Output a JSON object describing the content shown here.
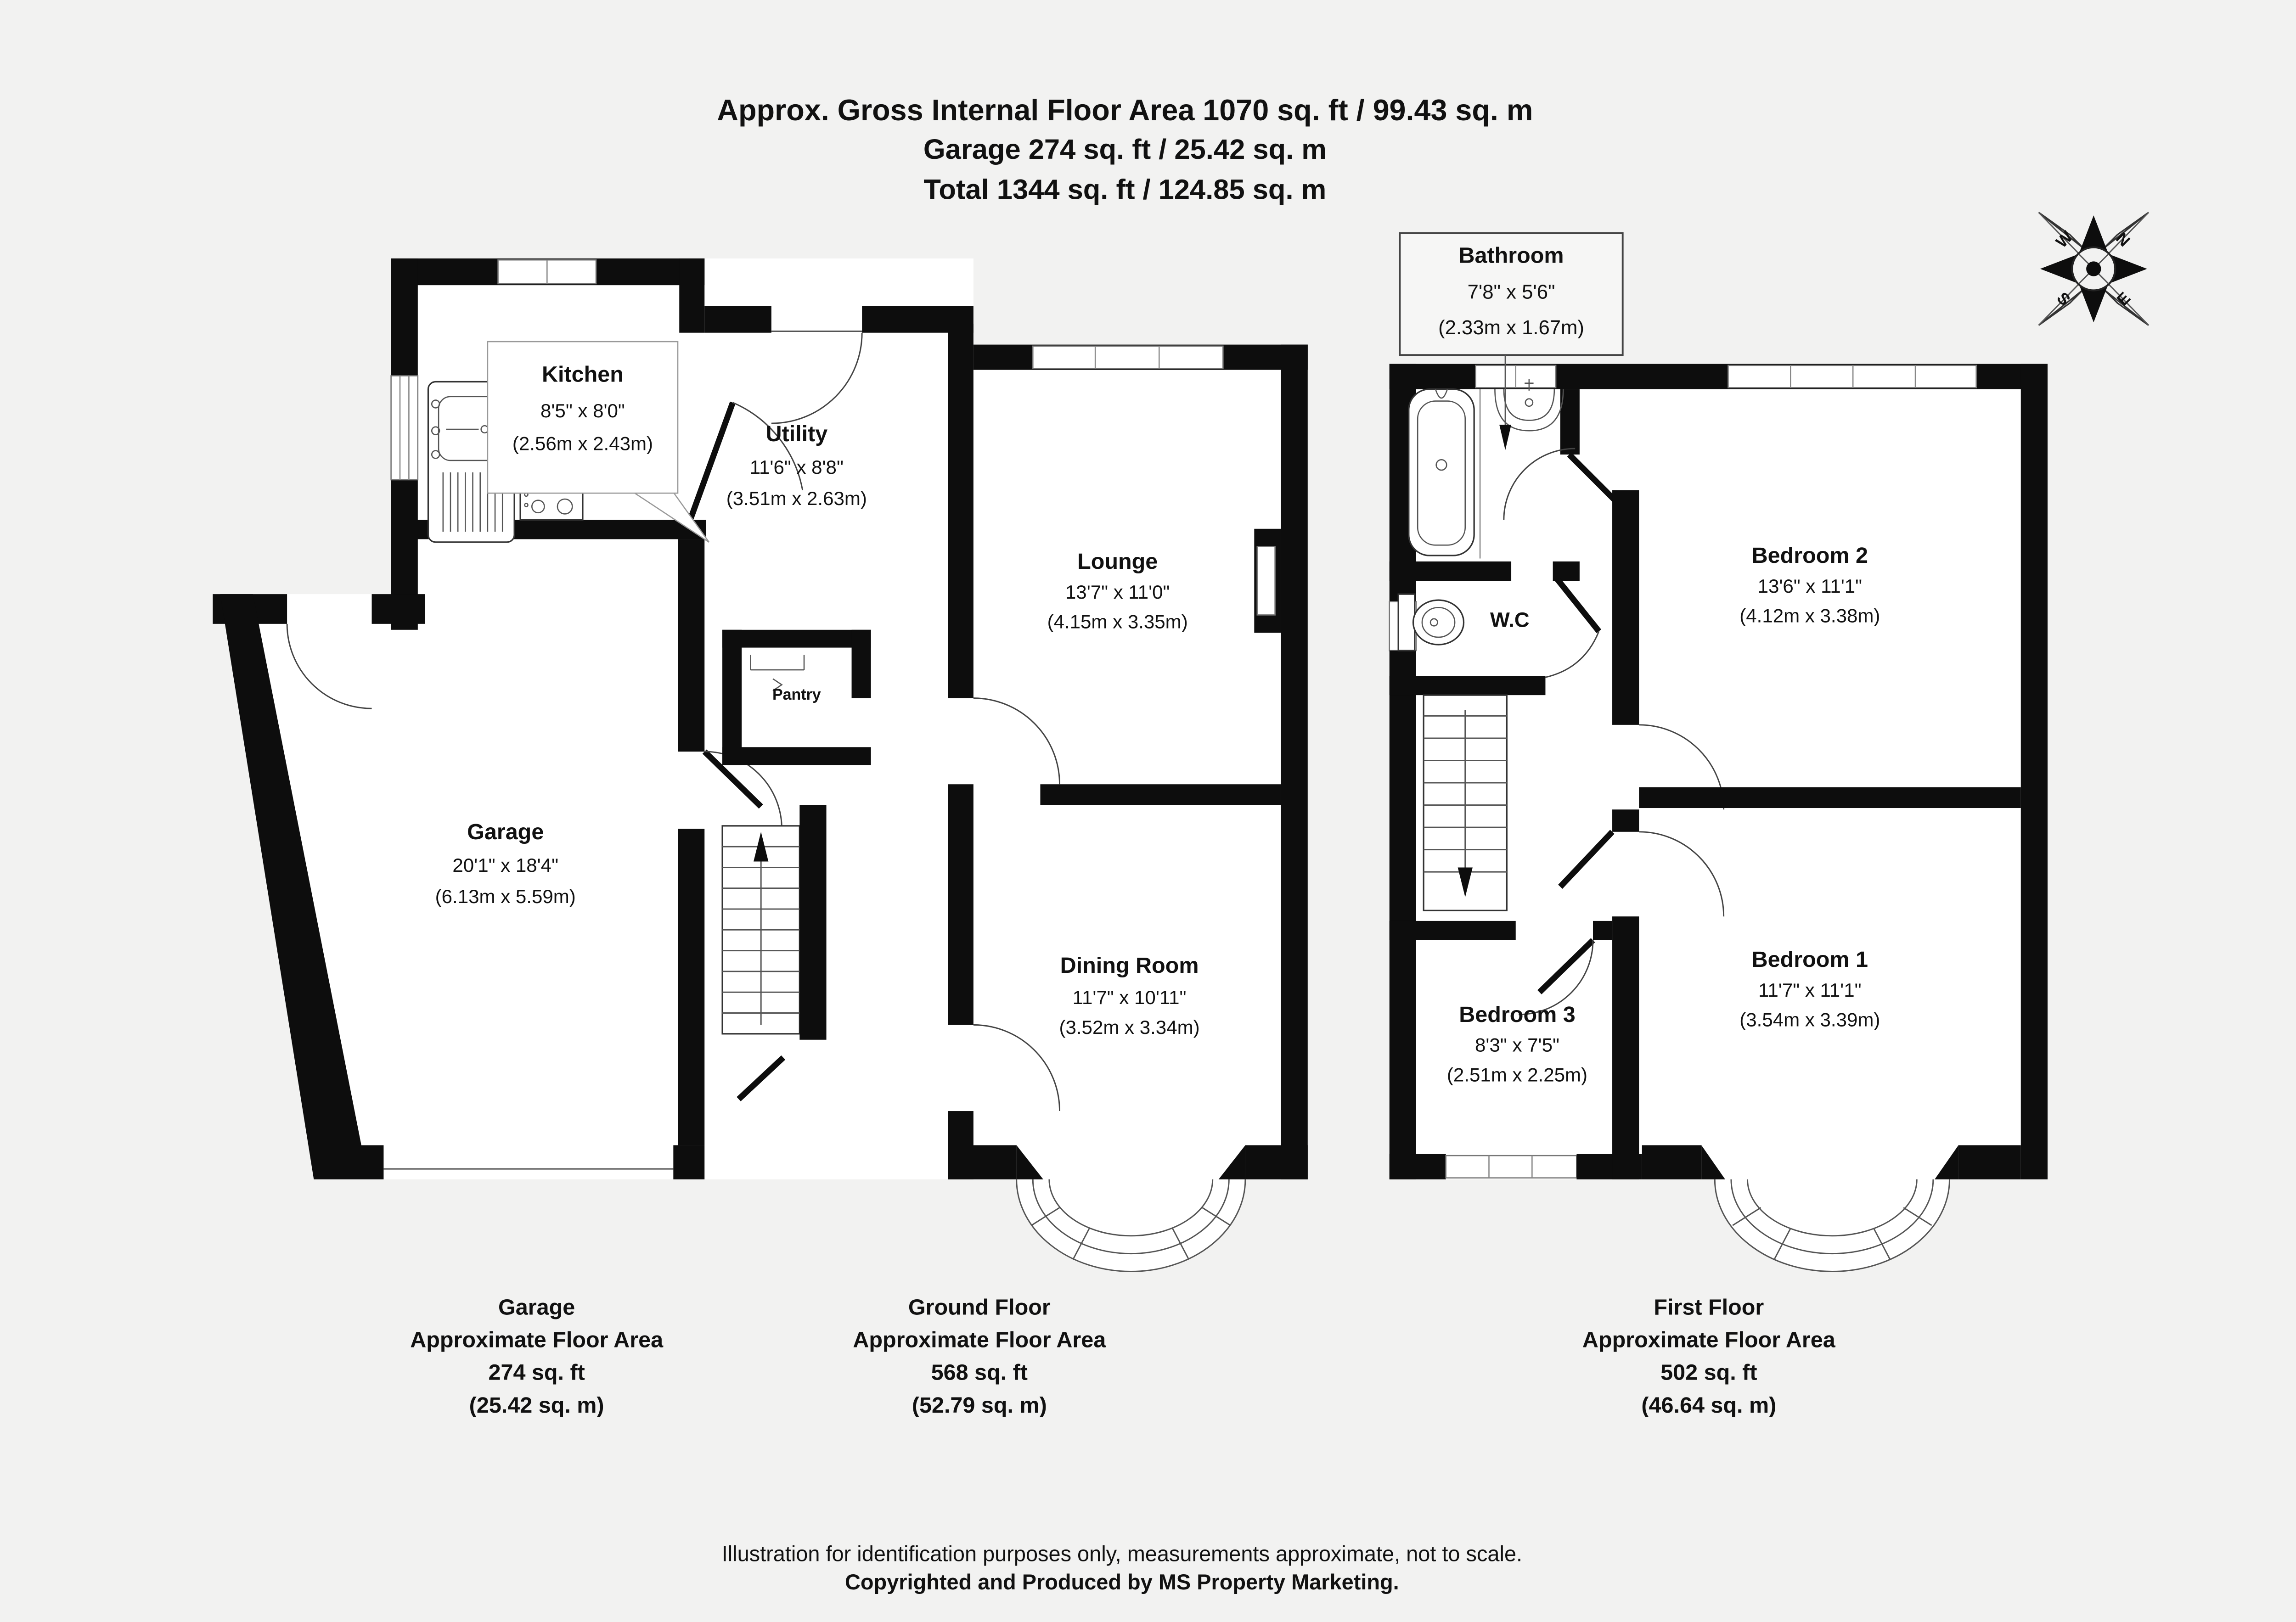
{
  "header": {
    "line1": "Approx. Gross Internal Floor Area 1070 sq. ft / 99.43 sq. m",
    "line2": "Garage 274 sq. ft / 25.42 sq. m",
    "line3": "Total 1344 sq. ft / 124.85 sq. m"
  },
  "compass": {
    "n": "N",
    "e": "E",
    "s": "S",
    "w": "W"
  },
  "ground_floor": {
    "rooms": {
      "kitchen": {
        "name": "Kitchen",
        "imperial": "8'5\" x 8'0\"",
        "metric": "(2.56m x 2.43m)"
      },
      "utility": {
        "name": "Utility",
        "imperial": "11'6\" x 8'8\"",
        "metric": "(3.51m x 2.63m)"
      },
      "lounge": {
        "name": "Lounge",
        "imperial": "13'7\" x 11'0\"",
        "metric": "(4.15m x 3.35m)"
      },
      "pantry": {
        "name": "Pantry"
      },
      "garage": {
        "name": "Garage",
        "imperial": "20'1\" x 18'4\"",
        "metric": "(6.13m x 5.59m)"
      },
      "dining": {
        "name": "Dining Room",
        "imperial": "11'7\" x 10'11\"",
        "metric": "(3.52m x 3.34m)"
      }
    }
  },
  "first_floor": {
    "rooms": {
      "bathroom": {
        "name": "Bathroom",
        "imperial": "7'8\" x 5'6\"",
        "metric": "(2.33m x 1.67m)"
      },
      "wc": {
        "name": "W.C"
      },
      "bedroom2": {
        "name": "Bedroom 2",
        "imperial": "13'6\" x 11'1\"",
        "metric": "(4.12m x 3.38m)"
      },
      "bedroom1": {
        "name": "Bedroom 1",
        "imperial": "11'7\" x 11'1\"",
        "metric": "(3.54m x 3.39m)"
      },
      "bedroom3": {
        "name": "Bedroom 3",
        "imperial": "8'3\" x 7'5\"",
        "metric": "(2.51m x 2.25m)"
      }
    }
  },
  "footers": {
    "garage": {
      "line1": "Garage",
      "line2": "Approximate Floor Area",
      "line3": "274 sq. ft",
      "line4": "(25.42 sq. m)"
    },
    "ground_floor": {
      "line1": "Ground Floor",
      "line2": "Approximate Floor Area",
      "line3": "568 sq. ft",
      "line4": "(52.79 sq. m)"
    },
    "first_floor": {
      "line1": "First Floor",
      "line2": "Approximate Floor Area",
      "line3": "502 sq. ft",
      "line4": "(46.64 sq. m)"
    }
  },
  "disclaimer": {
    "line1": "Illustration for identification purposes only, measurements approximate, not to scale.",
    "line2": "Copyrighted  and Produced by MS Property Marketing."
  },
  "colors": {
    "wall": "#0d0d0d",
    "background": "#f2f2f1",
    "floor": "#ffffff"
  }
}
